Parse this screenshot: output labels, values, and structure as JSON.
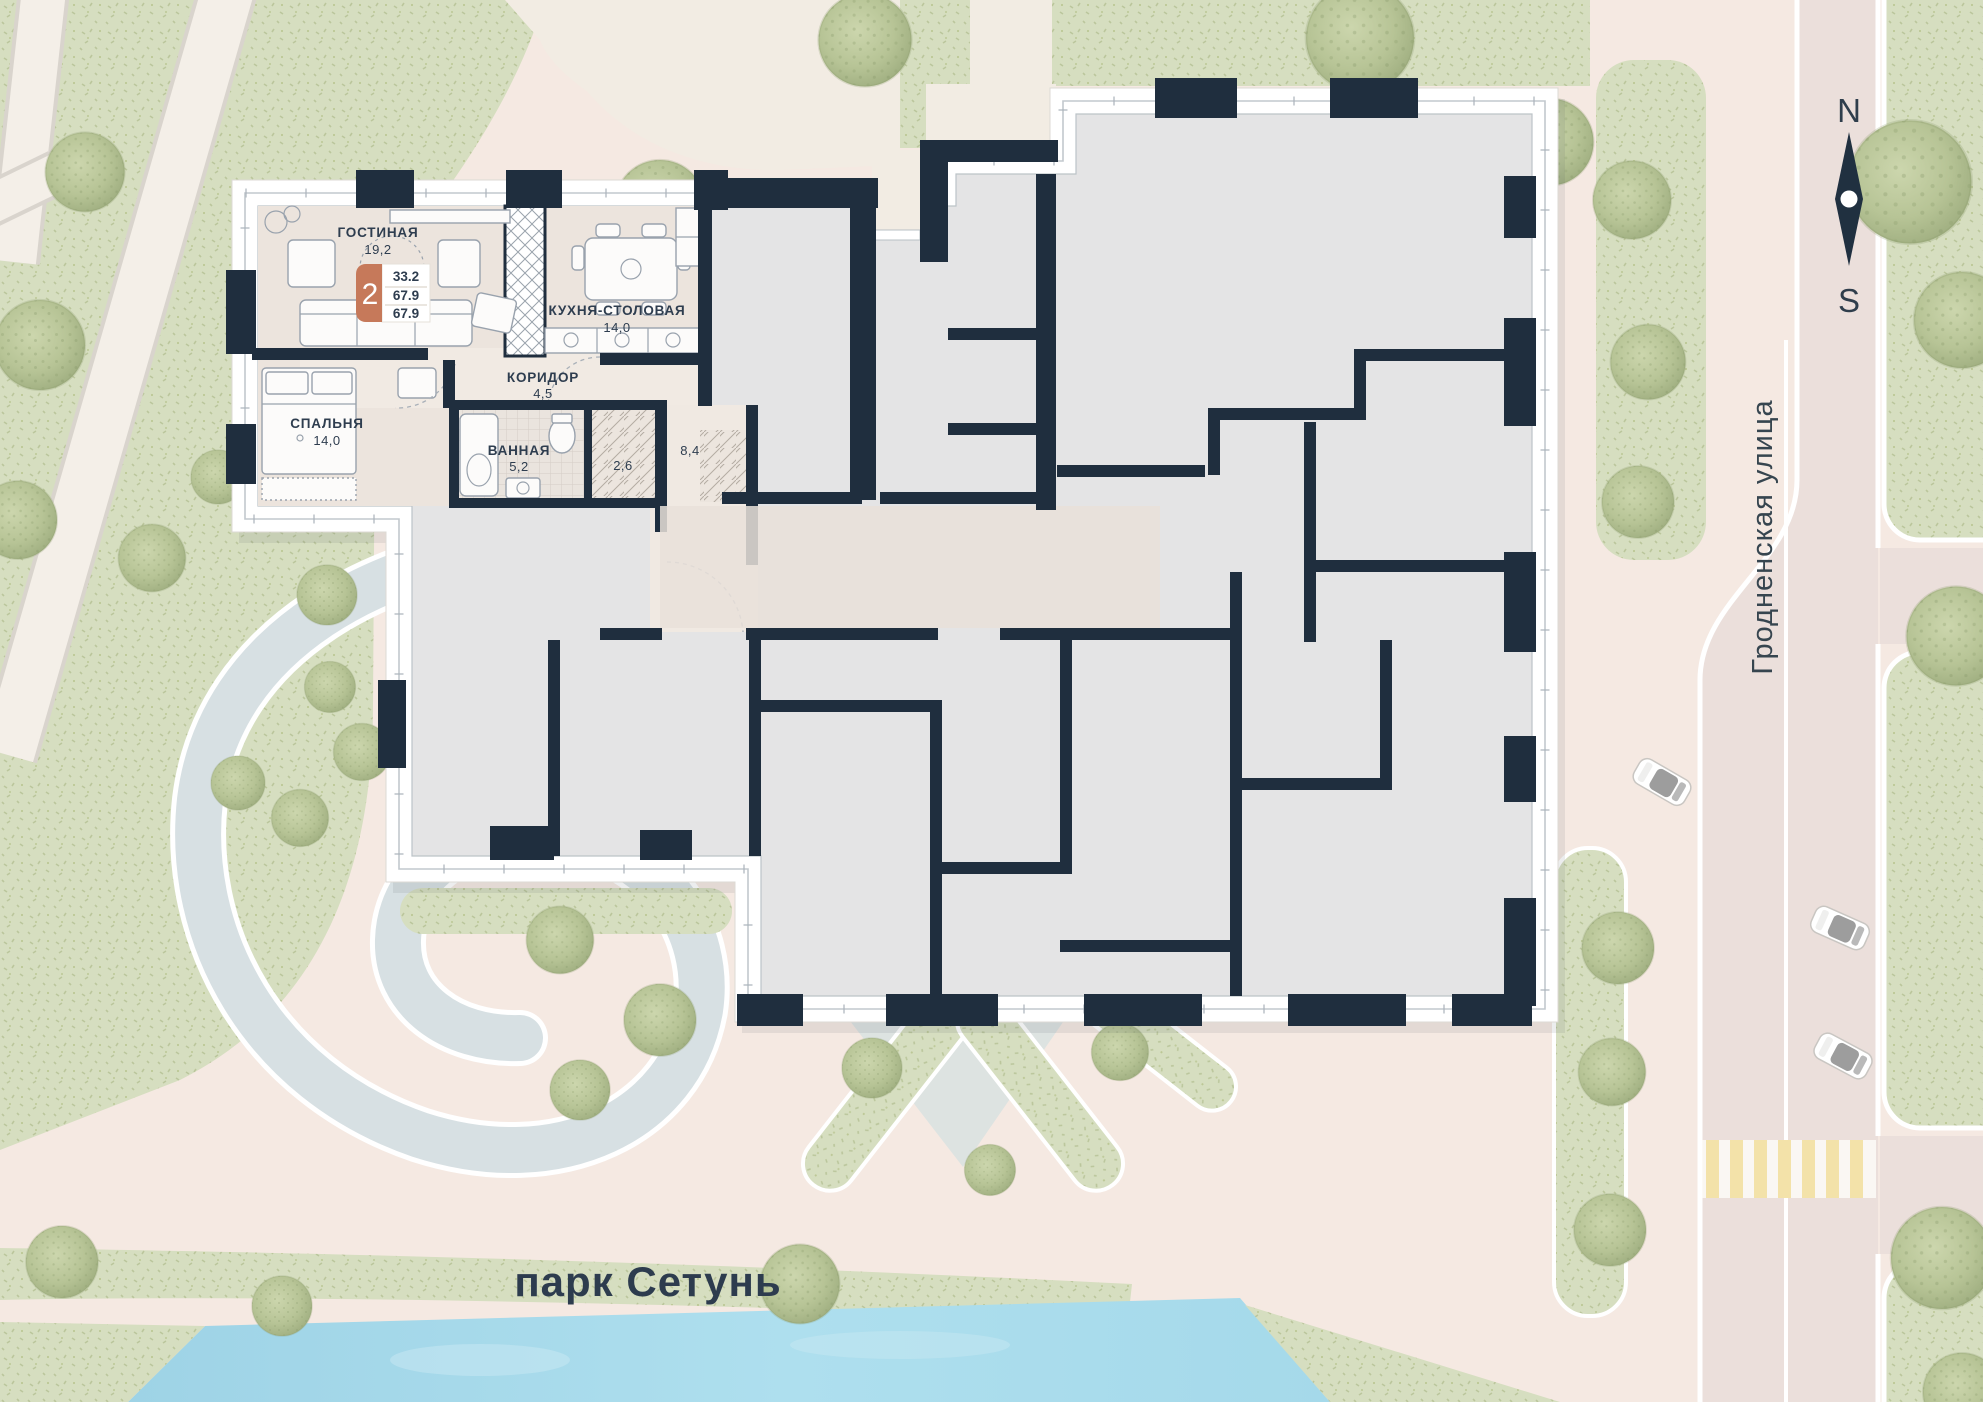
{
  "plan": {
    "apartment": {
      "rooms_badge": "2",
      "living_area": "33.2",
      "total_area": "67.9",
      "total_area_2": "67.9"
    },
    "rooms": [
      {
        "name": "ГОСТИНАЯ",
        "area": "19,2"
      },
      {
        "name": "КУХНЯ-СТОЛОВАЯ",
        "area": "14,0"
      },
      {
        "name": "КОРИДОР",
        "area": "4,5"
      },
      {
        "name": "СПАЛЬНЯ",
        "area": "14,0"
      },
      {
        "name": "ВАННАЯ",
        "area": "5,2"
      },
      {
        "name": "",
        "area": "2,6"
      },
      {
        "name": "",
        "area": "8,4"
      }
    ]
  },
  "map": {
    "park_label": "парк Сетунь",
    "street_label": "Гродненская улица",
    "compass": {
      "north": "N",
      "south": "S"
    }
  },
  "colors": {
    "wall": "#1f2e3e",
    "unit_gray": "#e4e4e5",
    "apartment_beige": "#ebe3dc",
    "badge_terracotta": "#c6795a",
    "park_green": "#d6dec0",
    "river_blue": "#a9dbea",
    "road": "#ebdfdb",
    "plaza": "#dde3e1"
  }
}
